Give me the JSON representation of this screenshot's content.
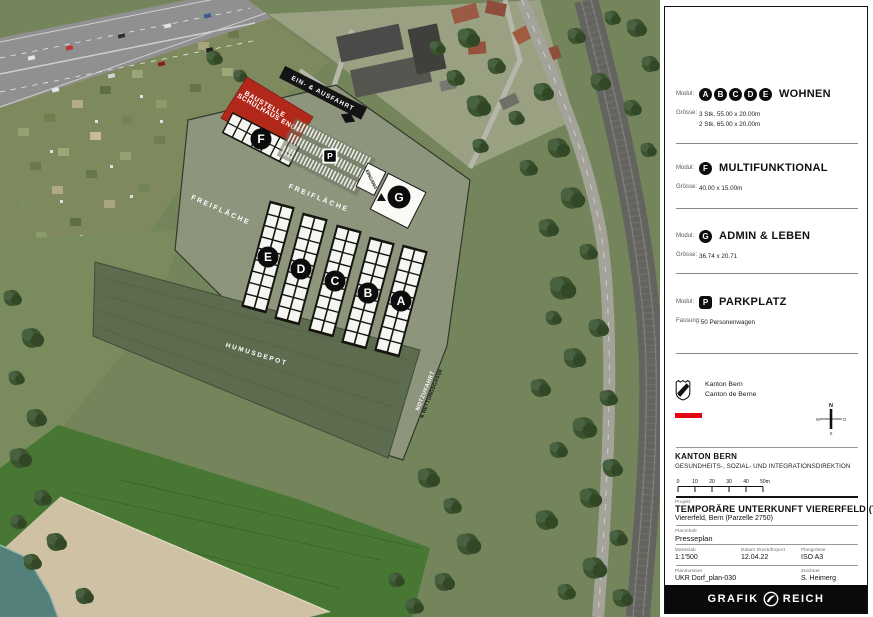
{
  "map": {
    "area_labels": {
      "baustelle_line1": "BAUSTELLE",
      "baustelle_line2": "SCHULHAUS ENGE",
      "ein_ausfahrt": "EIN- & AUSFAHRT",
      "freiflaeche": "FREIFLÄCHE",
      "humusdepot": "HUMUSDEPOT",
      "notzufahrt": "NOTZUFAHRT",
      "rettungsgasse": "& RETTUNGSGASSE",
      "eingang": "EINGANG"
    },
    "buildings": {
      "a": "A",
      "b": "B",
      "c": "C",
      "d": "D",
      "e": "E",
      "f": "F",
      "g": "G",
      "p": "P"
    }
  },
  "legend": {
    "sections": [
      {
        "label": "Modul:",
        "badges": [
          "A",
          "B",
          "C",
          "D",
          "E"
        ],
        "title": "WOHNEN",
        "size_label": "Grösse:",
        "size_lines": [
          "3 Stk. 55.00 x 20.00m",
          "2 Stk. 65.00 x 20.00m"
        ]
      },
      {
        "label": "Modul:",
        "badges": [
          "F"
        ],
        "title": "MULTIFUNKTIONAL",
        "size_label": "Grösse:",
        "size_lines": [
          "40.00 x 15.00m"
        ]
      },
      {
        "label": "Modul:",
        "badges": [
          "G"
        ],
        "title": "ADMIN & LEBEN",
        "size_label": "Grösse:",
        "size_lines": [
          "36.74 x 20.71"
        ]
      },
      {
        "label": "Modul:",
        "badges": [
          "P"
        ],
        "title": "PARKPLATZ",
        "size_label": "Fassung:",
        "size_lines": [
          "50 Personenwagen"
        ]
      }
    ]
  },
  "agency": {
    "logo_line1": "Kanton Bern",
    "logo_line2": "Canton de Berne",
    "name": "KANTON BERN",
    "department": "GESUNDHEITS-, SOZIAL- UND INTEGRATIONSDIREKTION",
    "compass": {
      "n": "N",
      "s": "S",
      "w": "W",
      "o": "O"
    }
  },
  "scalebar": {
    "ticks": [
      "0",
      "10",
      "20",
      "30",
      "40",
      "50m"
    ]
  },
  "titleblock": {
    "project_label": "Projekt",
    "project_title": "TEMPORÄRE UNTERKUNFT VIERERFELD (TUV)",
    "project_subtitle": "Viererfeld, Bern (Parzelle 2750)",
    "content_label": "Planinhalt",
    "content_value": "Presseplan",
    "scale_label": "Massstab",
    "scale_value": "1:1'500",
    "date_label": "Datum Druck/Export",
    "date_value": "12.04.22",
    "size_label": "Plangrösse",
    "size_value": "ISO A3",
    "plan_number_label": "Plannummer",
    "plan_number_value": "UKR Dorf_plan-030",
    "author_label": "Zeichner",
    "author_value": "S. Heimerg"
  },
  "footer": {
    "brand_left": "GRAFIK",
    "brand_right": "REICH"
  },
  "colors": {
    "accent_red": "#b2291c",
    "kanton_red": "#e30613",
    "overlay_light": "#8d957c",
    "overlay_dark": "#5d6b4f",
    "black": "#111111"
  }
}
